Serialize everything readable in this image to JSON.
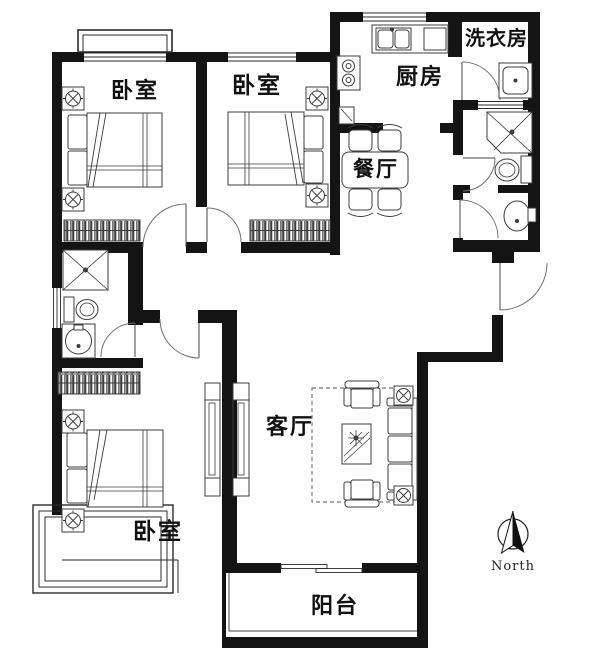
{
  "rooms": {
    "bedroom_top_left": {
      "label": "卧室"
    },
    "bedroom_top_middle": {
      "label": "卧室"
    },
    "bedroom_bottom_left": {
      "label": "卧室"
    },
    "kitchen": {
      "label": "厨房"
    },
    "laundry_room": {
      "label": "洗衣房"
    },
    "dining_room": {
      "label": "餐厅"
    },
    "living_room": {
      "label": "客厅"
    },
    "balcony": {
      "label": "阳台"
    }
  },
  "compass": {
    "north_label": "North"
  },
  "colors": {
    "wall": "#141414",
    "furniture_line": "#3c3c3c",
    "door_line": "#707070",
    "background": "#ffffff"
  }
}
